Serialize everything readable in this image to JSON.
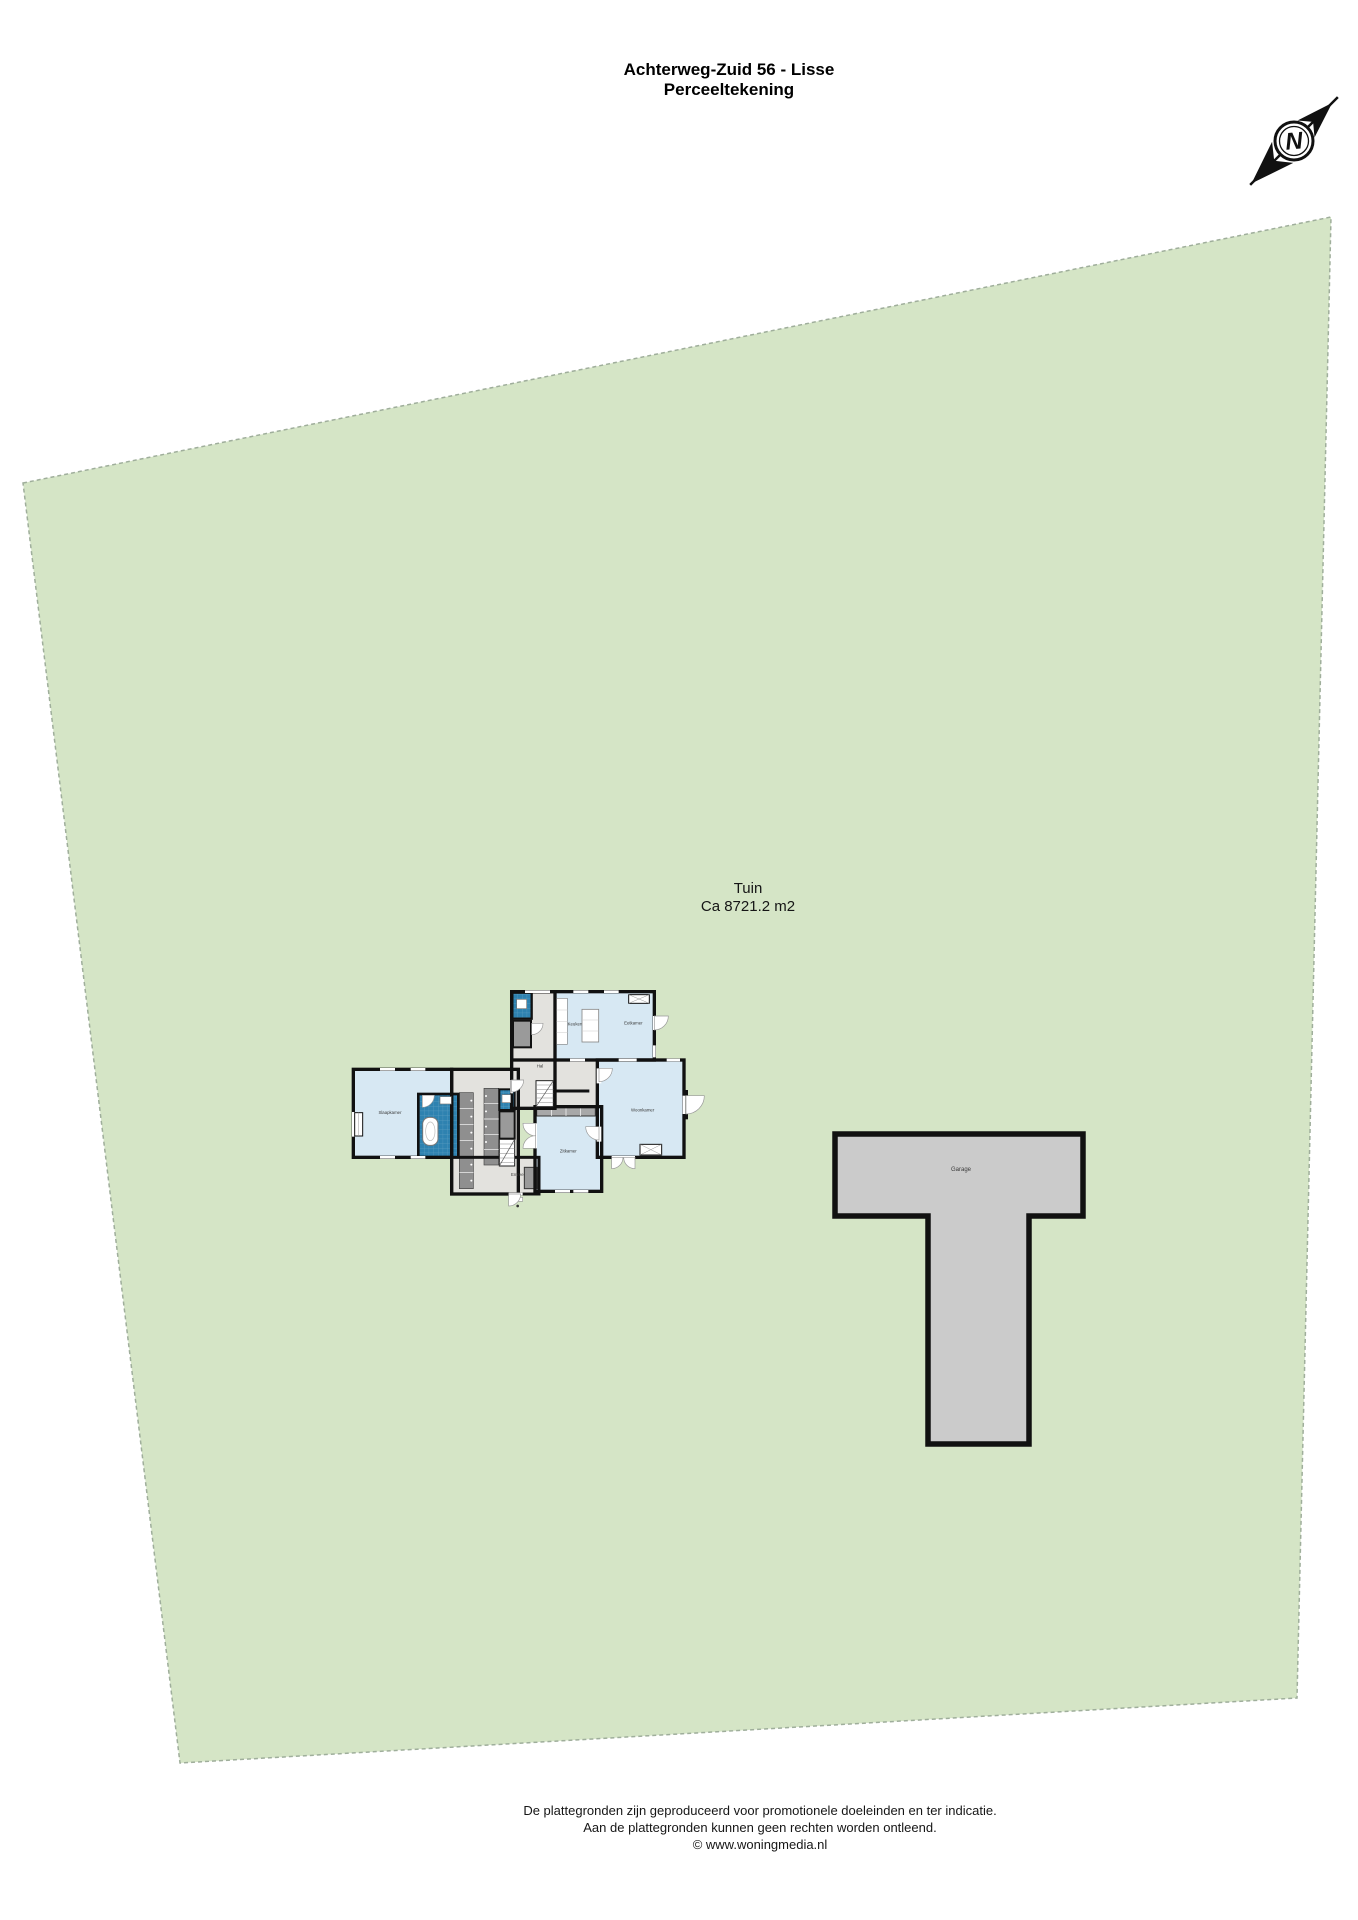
{
  "header": {
    "title": "Achterweg-Zuid 56 - Lisse",
    "subtitle": "Perceeltekening"
  },
  "compass": {
    "letter": "N"
  },
  "garden": {
    "label": "Tuin",
    "area": "Ca 8721.2 m2"
  },
  "structures": {
    "garage_label": "Garage"
  },
  "floorplan": {
    "rooms": [
      {
        "id": "keuken",
        "label": "Keuken"
      },
      {
        "id": "eetkamer",
        "label": "Eetkamer"
      },
      {
        "id": "hal",
        "label": "Hal"
      },
      {
        "id": "woonkamer",
        "label": "Woonkamer"
      },
      {
        "id": "zitkamer",
        "label": "Zitkamer"
      },
      {
        "id": "slaapkamer",
        "label": "Slaapkamer"
      },
      {
        "id": "entree",
        "label": "Entree"
      }
    ]
  },
  "palette": {
    "plot_green": "#d5e5c6",
    "plot_border": "#9fae9b",
    "paving_gray": "#cbcbcb",
    "room_blue": "#d7e8f3",
    "wet_room_blue": "#2e82b0",
    "floor_gray": "#e3e2de",
    "closet_gray": "#8f8f8f",
    "wall_black": "#111111"
  },
  "footer": {
    "line1": "De plattegronden zijn geproduceerd voor promotionele doeleinden en ter indicatie.",
    "line2": "Aan de plattegronden kunnen geen rechten worden ontleend.",
    "line3": "© www.woningmedia.nl"
  }
}
